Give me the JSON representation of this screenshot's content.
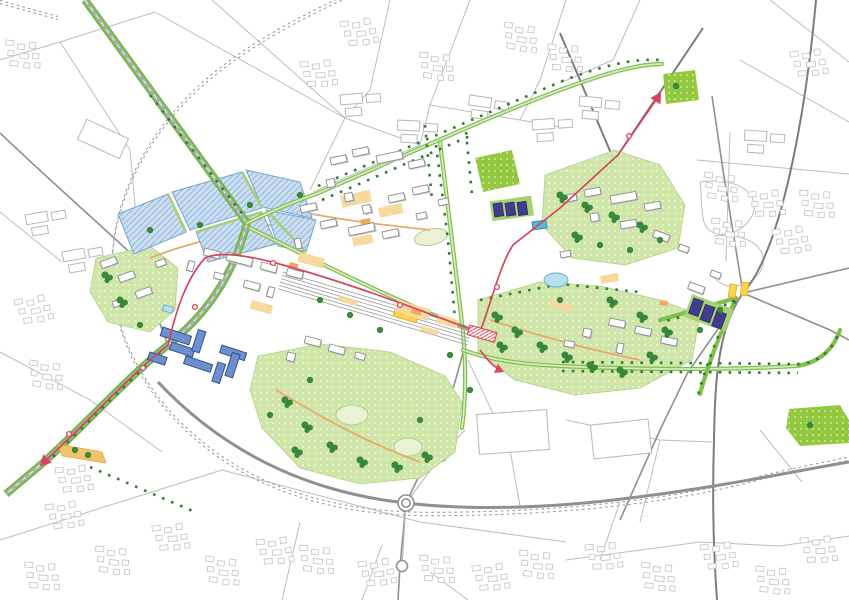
{
  "map": {
    "kind": "urban-masterplan-plan-view",
    "features": [
      {
        "name": "water-basins",
        "fill": "water_fill",
        "count": 5
      },
      {
        "name": "railway-ring-dashed",
        "stroke": "railway"
      },
      {
        "name": "motorway-bypass",
        "stroke": "road_medium",
        "roundabouts": 3
      },
      {
        "name": "green-boulevard-northwest",
        "stroke": "boulevard_green"
      },
      {
        "name": "tram-line-east",
        "stroke": "tram_red",
        "stops": 2,
        "arrows": 1
      },
      {
        "name": "tram-line-west",
        "stroke": "tram_red",
        "stops": 5,
        "arrows": 1
      },
      {
        "name": "station-tracks",
        "stroke": "railway"
      },
      {
        "name": "station-red-hatched-building",
        "stroke": "tram_red"
      },
      {
        "name": "south-park",
        "fill": "park_fill"
      },
      {
        "name": "southeast-park",
        "fill": "park_fill"
      },
      {
        "name": "northeast-park",
        "fill": "park_fill"
      },
      {
        "name": "west-park",
        "fill": "park_fill"
      },
      {
        "name": "sports-oval",
        "fill": "field_pale"
      },
      {
        "name": "playing-field",
        "fill": "park_bright"
      },
      {
        "name": "bright-green-field-topright",
        "fill": "park_bright"
      },
      {
        "name": "bright-green-field-bottomright",
        "fill": "park_bright"
      },
      {
        "name": "blue-building-cluster",
        "fill": "blue_building",
        "count": 8
      },
      {
        "name": "navy-building-rows",
        "fill": "navy_building",
        "clusters": 2
      },
      {
        "name": "white-campus-buildings",
        "fill": "building_white"
      },
      {
        "name": "context-buildings",
        "stroke": "context_stroke"
      },
      {
        "name": "tan-plazas",
        "fill": "plaza_tan"
      },
      {
        "name": "yellow-crossing-junction",
        "fill": "junction_yellow"
      },
      {
        "name": "yellow-strip-southwest",
        "fill": "strip_yellow"
      },
      {
        "name": "swimming-pool",
        "fill": "pool_blue"
      },
      {
        "name": "pond",
        "fill": "pond_blue"
      },
      {
        "name": "street-tree-rows",
        "stroke": "tree_dark"
      }
    ]
  },
  "colors": {
    "background": "#ffffff",
    "road_thin": "#bdbdbd",
    "road_medium": "#909090",
    "road_dark": "#7c7c7c",
    "road_inner": "#ababab",
    "railway": "#9c9c9c",
    "boulevard_green": "#6abf3a",
    "route_green": "#7fbf4a",
    "route_green_light": "#d8e9c2",
    "strip_green": "#a7d172",
    "dyke_green": "#a5cf78",
    "tree_dark": "#2f7d32",
    "tree_mid": "#3a8a3c",
    "park_fill": "#cfe6a8",
    "park_edge": "#b2d089",
    "park_bright": "#94c83f",
    "field_pale": "#e9f2d4",
    "water_fill": "#c9def1",
    "water_hatch": "#8fb3d8",
    "water_edge": "#76a5cf",
    "building_white": "#ffffff",
    "building_stroke": "#8d8d8d",
    "building_shadow": "#c2c2c2",
    "context_stroke": "#c9c9c9",
    "industry_stroke": "#b8b8b8",
    "blue_building": "#6d8fcd",
    "blue_building_stroke": "#35508f",
    "navy_building": "#413d8e",
    "navy_building_stroke": "#2a2668",
    "tram_red": "#d6455e",
    "plaza_tan": "#f7d9a0",
    "plaza_orange": "#f0a95c",
    "path_orange": "#e8a96a",
    "strip_yellow": "#f5c46a",
    "strip_yellow_edge": "#dca33e",
    "junction_yellow": "#fbd34f",
    "junction_yellow_edge": "#e0a92e",
    "pool_blue": "#59b7dd",
    "pool_edge": "#2e86b0",
    "pond_blue": "#b9e0f0",
    "pond_edge": "#6aaed0"
  }
}
